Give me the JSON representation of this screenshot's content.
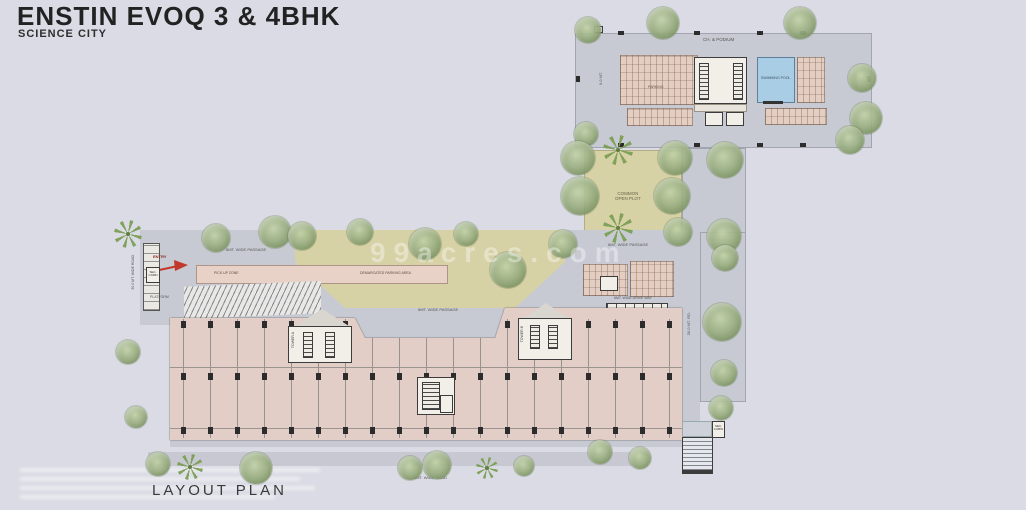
{
  "header": {
    "title": "ENSTIN EVOQ 3 & 4BHK",
    "subtitle": "SCIENCE CITY"
  },
  "footer": {
    "plan_label": "LAYOUT PLAN",
    "bottom_road_label": "9MT. WIDE ROAD"
  },
  "watermark": {
    "text": "99acres.com"
  },
  "clubhouse": {
    "podium_label": "CH. & PODIUM",
    "pool_label": "SWIMMING POOL",
    "parking_label": "PARKING",
    "dim_left_label": "9.0 MT.",
    "dim_right_label": "15.0 MT."
  },
  "site": {
    "common_plot_line1": "COMMON",
    "common_plot_line2": "OPEN PLOT",
    "passage_label": "6MT. WIDE PASSAGE",
    "driveway_label": "6MT. WIDE DRIVE WAY",
    "entry_label": "ENTRY",
    "security_cabin_label": "SEC. CABIN",
    "platform_label": "PLATFORM",
    "pickup_zone_label": "PICK UP ZONE",
    "demarcated_parking_label": "DEMARCATED PARKING AREA",
    "road_left_label": "30.0 MT. WIDE ROAD",
    "road_right_label": "30.0 MT. RD.",
    "tower_a_label": "TOWER A",
    "tower_b_label": "TOWER B"
  },
  "colors": {
    "background": "#dadbe4",
    "deck": "#c7cad3",
    "building": "#e3cec7",
    "garden": "#d7d1a6",
    "pool": "#a9cde5",
    "entry_arrow": "#c0392b"
  }
}
